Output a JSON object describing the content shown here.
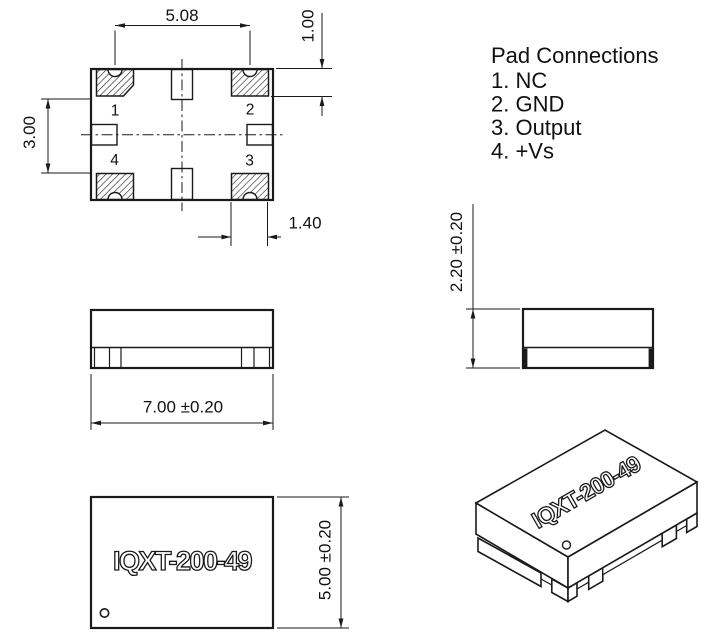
{
  "legend": {
    "title": "Pad Connections",
    "items": [
      "1. NC",
      "2. GND",
      "3. Output",
      "4. +Vs"
    ]
  },
  "top_view": {
    "pad_labels": {
      "pad1": "1",
      "pad2": "2",
      "pad3": "3",
      "pad4": "4"
    },
    "dim_pad_pitch": "5.08",
    "dim_pad_height": "1.00",
    "dim_inner_gap": "3.00",
    "dim_pad_width": "1.40"
  },
  "front_view": {
    "dim_length": "7.00 ±0.20"
  },
  "side_view": {
    "dim_height": "2.20 ±0.20"
  },
  "bottom_view": {
    "part_number": "IQXT-200-49",
    "dim_width": "5.00 ±0.20"
  },
  "iso_view": {
    "part_number": "IQXT-200-49"
  },
  "colors": {
    "line": "#1a1a1a",
    "background": "#ffffff"
  }
}
